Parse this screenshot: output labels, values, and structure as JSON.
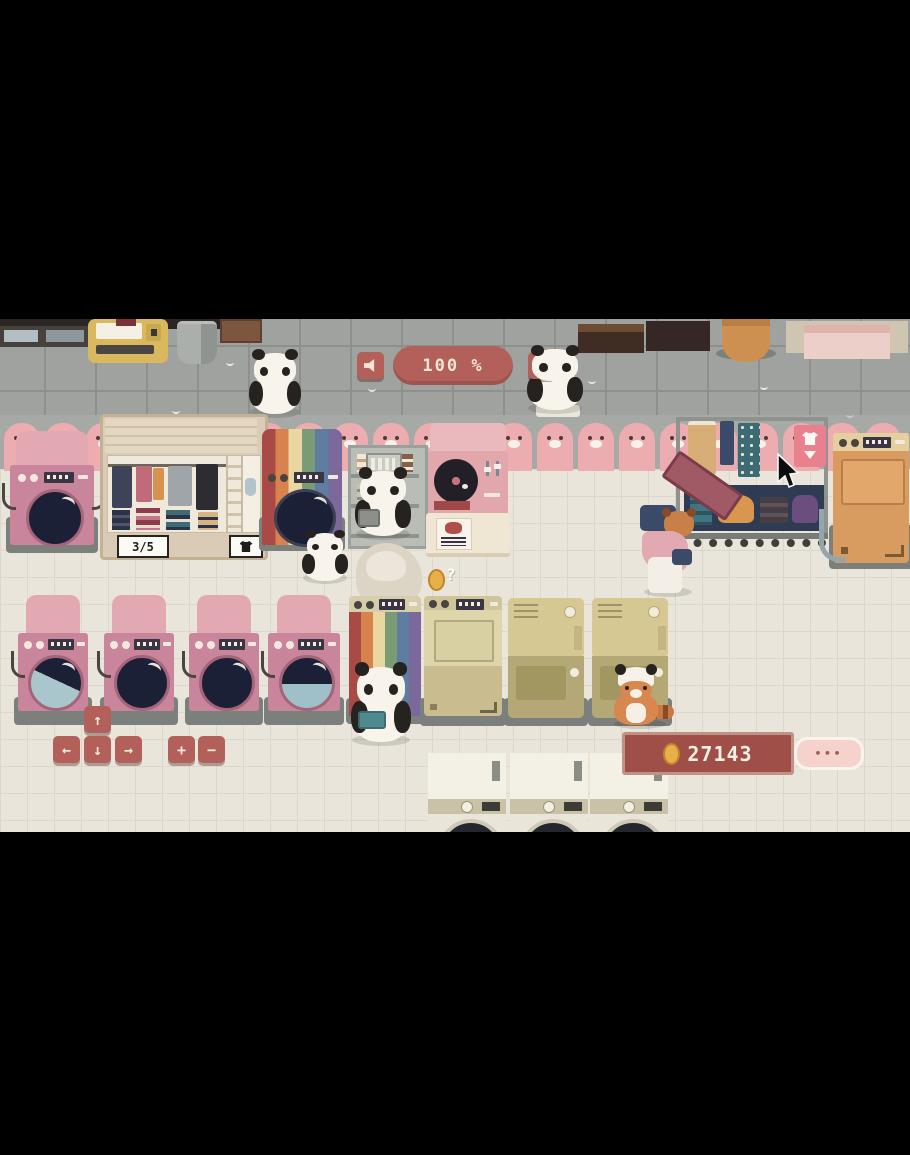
{
  "hud": {
    "volume": {
      "label": "100 %",
      "down_icon": "speaker-icon",
      "up_icon": "speaker-waves-icon"
    },
    "coins": {
      "value": "27143",
      "icon": "coin-icon"
    },
    "more": {
      "label": "•••"
    },
    "controls": {
      "up": "↑",
      "left": "←",
      "down": "↓",
      "right": "→",
      "zoom_in": "+",
      "zoom_out": "−"
    }
  },
  "shop": {
    "wardrobe": {
      "capacity": "3/5",
      "icon": "shirt-icon"
    },
    "drop_sign": {
      "icon": "shirt-down-icon"
    },
    "floating_question": "?"
  },
  "colors": {
    "ui_red": "#b3605b",
    "panel_red": "#a04f48",
    "coin_gold": "#e8b04a",
    "wall_pink": "#edadb0",
    "washer_pink": "#c9859b",
    "floor_cream": "#e9e5da",
    "sidewalk_gray": "#9fa29f",
    "khaki": "#d5c893",
    "orange_machine": "#d99c60"
  }
}
